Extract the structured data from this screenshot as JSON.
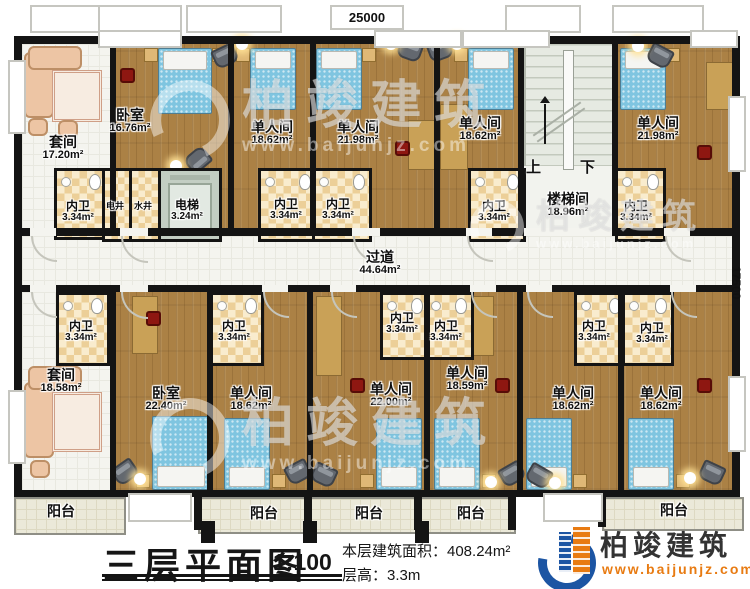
{
  "dimensions": {
    "top": "25000",
    "right": "17500"
  },
  "stairwell": {
    "up": "上",
    "down": "下"
  },
  "rooms": [
    {
      "label": "套间",
      "area": "17.20m²"
    },
    {
      "label": "卧室",
      "area": "16.76m²"
    },
    {
      "label": "单人间",
      "area": "18.62m²"
    },
    {
      "label": "单人间",
      "area": "21.98m²"
    },
    {
      "label": "单人间",
      "area": "18.62m²"
    },
    {
      "label": "楼梯间",
      "area": "18.96m²"
    },
    {
      "label": "单人间",
      "area": "21.98m²"
    },
    {
      "label": "内卫",
      "area": "3.34m²"
    },
    {
      "label": "电井"
    },
    {
      "label": "水井"
    },
    {
      "label": "电梯",
      "area": "3.24m²"
    },
    {
      "label": "内卫",
      "area": "3.34m²"
    },
    {
      "label": "内卫",
      "area": "3.34m²"
    },
    {
      "label": "内卫",
      "area": "3.34m²"
    },
    {
      "label": "内卫",
      "area": "3.34m²"
    },
    {
      "label": "过道",
      "area": "44.64m²"
    },
    {
      "label": "内卫",
      "area": "3.34m²"
    },
    {
      "label": "内卫",
      "area": "3.34m²"
    },
    {
      "label": "内卫",
      "area": "3.34m²"
    },
    {
      "label": "内卫",
      "area": "3.34m²"
    },
    {
      "label": "内卫",
      "area": "3.34m²"
    },
    {
      "label": "内卫",
      "area": "3.34m²"
    },
    {
      "label": "套间",
      "area": "18.58m²"
    },
    {
      "label": "卧室",
      "area": "22.40m²"
    },
    {
      "label": "单人间",
      "area": "18.62m²"
    },
    {
      "label": "单人间",
      "area": "22.00m²"
    },
    {
      "label": "单人间",
      "area": "18.59m²"
    },
    {
      "label": "单人间",
      "area": "18.62m²"
    },
    {
      "label": "单人间",
      "area": "18.62m²"
    }
  ],
  "balconies": [
    "阳台",
    "阳台",
    "阳台",
    "阳台",
    "阳台"
  ],
  "title": {
    "name": "三层平面图",
    "scale": "1:100",
    "building_area": "本层建筑面积：408.24m²",
    "floor_height": "层高：3.3m"
  },
  "logo": {
    "name": "柏竣建筑",
    "website": "www.baijunjz.com"
  },
  "watermark": {
    "brand": "柏竣建筑",
    "website": "www.baijunjz.com"
  },
  "colors": {
    "wood": "#ab8145",
    "bath_tile": "#eccf98",
    "wall": "#141414",
    "logo_blue": "#1c55a3",
    "logo_orange": "#e87b12"
  }
}
